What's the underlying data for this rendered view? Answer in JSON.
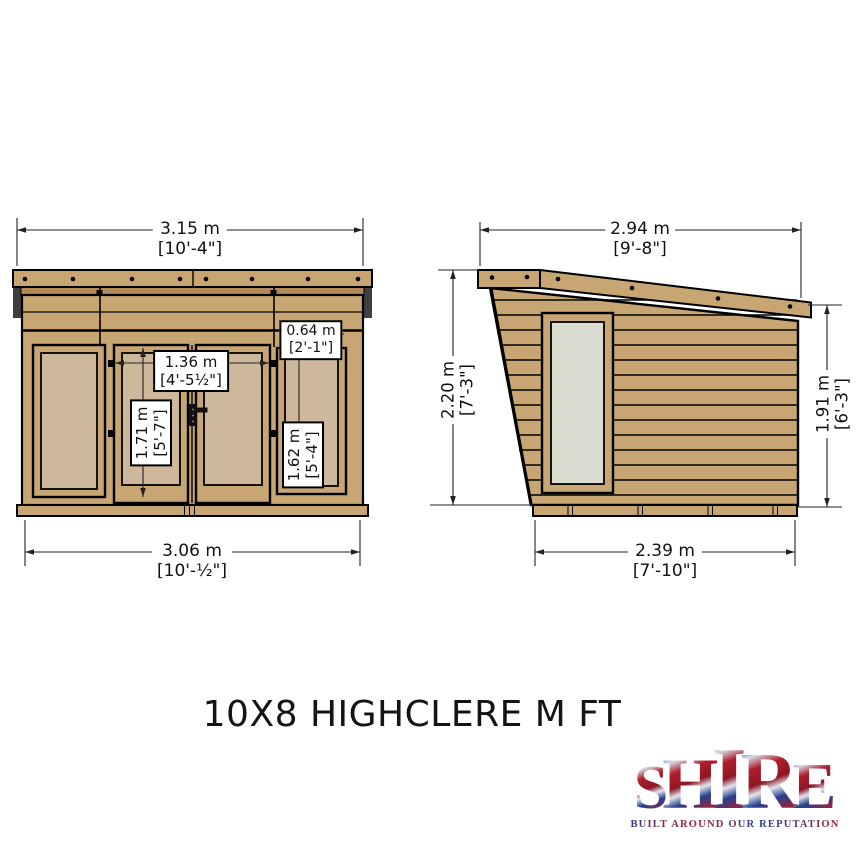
{
  "title": "10X8 HIGHCLERE M FT",
  "views": {
    "front": "front-elevation",
    "side": "side-elevation"
  },
  "dimensions": {
    "front_overall_width": {
      "metric": "3.15 m",
      "imperial": "[10'-4\"]"
    },
    "front_base_width": {
      "metric": "3.06 m",
      "imperial": "[10'-½\"]"
    },
    "door_width": {
      "metric": "1.36 m",
      "imperial": "[4'-5½\"]"
    },
    "door_height": {
      "metric": "1.71 m",
      "imperial": "[5'-7\"]"
    },
    "window_width": {
      "metric": "0.64 m",
      "imperial": "[2'-1\"]"
    },
    "window_height": {
      "metric": "1.62 m",
      "imperial": "[5'-4\"]"
    },
    "side_overall_depth": {
      "metric": "2.94 m",
      "imperial": "[9'-8\"]"
    },
    "side_base_depth": {
      "metric": "2.39 m",
      "imperial": "[7'-10\"]"
    },
    "front_height": {
      "metric": "2.20 m",
      "imperial": "[7'-3\"]"
    },
    "rear_height": {
      "metric": "1.91 m",
      "imperial": "[6'-3\"]"
    }
  },
  "logo": {
    "letters": [
      "S",
      "H",
      "I",
      "R",
      "E"
    ],
    "tagline": "BUILT AROUND OUR REPUTATION"
  },
  "colors": {
    "wood": "#C8A674",
    "wood_dark": "#B28A58",
    "glass_front": "#CDB89B",
    "glass_side": "#DBDCD0",
    "logo_red": "#B01E2E",
    "logo_blue": "#24408E"
  }
}
